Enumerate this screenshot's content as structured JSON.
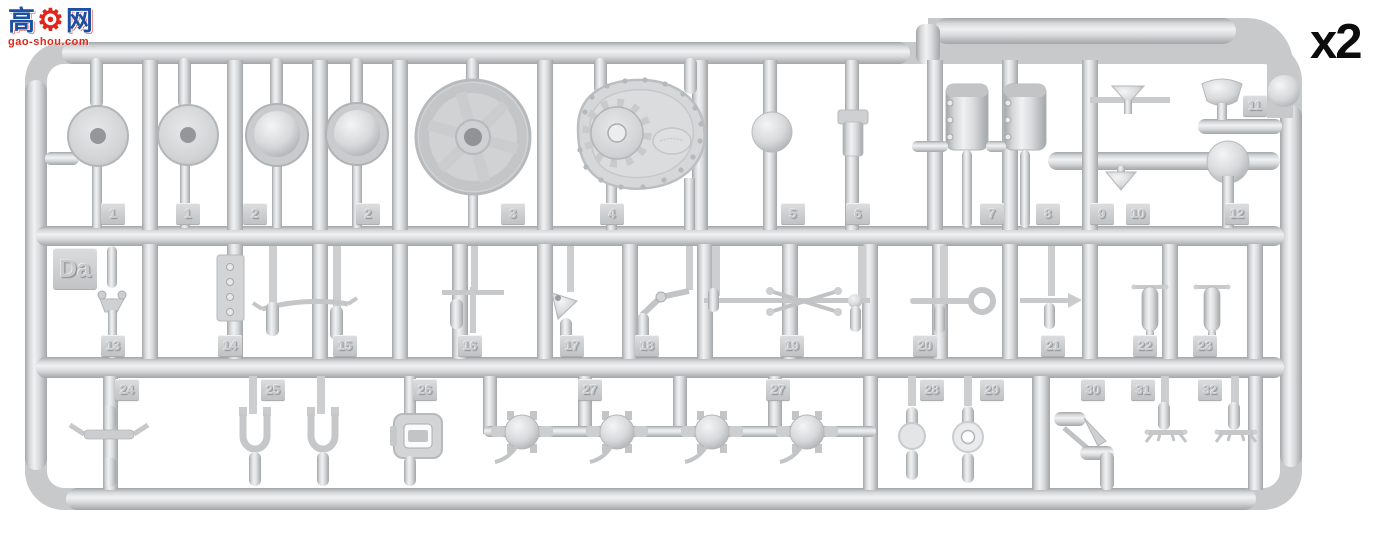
{
  "watermark": {
    "char_left": "高",
    "gear_glyph": "⚙",
    "char_right": "网",
    "domain_text": "gao-shou.com",
    "color_blue": "#1d4fa3",
    "color_red": "#e1251b"
  },
  "quantity_label": "x2",
  "sprue": {
    "code_label": "Da",
    "plastic_color": "#d3d5d7",
    "background_color": "#ffffff",
    "tags_row1": [
      "1",
      "1",
      "2",
      "2",
      "3",
      "4",
      "5",
      "6",
      "7",
      "8",
      "9",
      "10",
      "12"
    ],
    "tag_11": "11",
    "tags_row2": [
      "13",
      "14",
      "15",
      "16",
      "17",
      "18",
      "19",
      "20",
      "21",
      "22",
      "23"
    ],
    "tags_row3": [
      "24",
      "25",
      "26",
      "27",
      "27",
      "28",
      "29",
      "30",
      "31",
      "32"
    ]
  }
}
